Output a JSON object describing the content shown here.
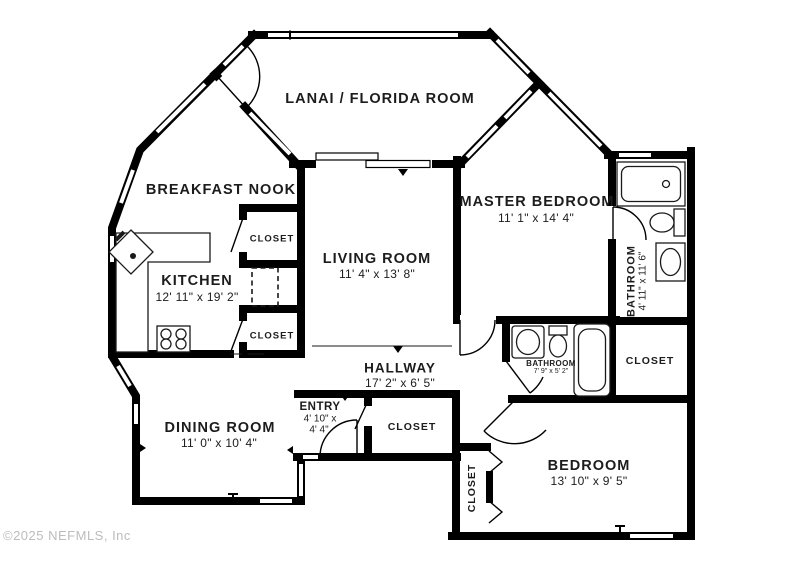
{
  "watermark": "©2025 NEFMLS, Inc",
  "rooms": {
    "lanai": {
      "name": "LANAI / FLORIDA ROOM"
    },
    "breakfast_nook": {
      "name": "BREAKFAST NOOK"
    },
    "kitchen": {
      "name": "KITCHEN",
      "dims": "12' 11\" x 19' 2\""
    },
    "living_room": {
      "name": "LIVING ROOM",
      "dims": "11' 4\" x 13' 8\""
    },
    "master_bedroom": {
      "name": "MASTER BEDROOM",
      "dims": "11' 1\" x 14' 4\""
    },
    "hallway": {
      "name": "HALLWAY",
      "dims": "17' 2\" x 6' 5\""
    },
    "entry": {
      "name": "ENTRY",
      "dims_line1": "4' 10\" x",
      "dims_line2": "4' 4\""
    },
    "dining_room": {
      "name": "DINING ROOM",
      "dims": "11' 0\" x 10' 4\""
    },
    "bedroom": {
      "name": "BEDROOM",
      "dims": "13' 10\" x 9' 5\""
    },
    "hall_bathroom": {
      "name": "BATHROOM",
      "dims": "4' 11\" x 11' 6\""
    },
    "master_bathroom": {
      "name": "BATHROOM",
      "dims": "7' 9\" x 5' 2\""
    },
    "closet_breakfast_top": {
      "name": "CLOSET"
    },
    "closet_breakfast_bottom": {
      "name": "CLOSET"
    },
    "closet_entry": {
      "name": "CLOSET"
    },
    "closet_bedroom": {
      "name": "CLOSET"
    },
    "closet_linen": {
      "name": "CLOSET"
    }
  }
}
